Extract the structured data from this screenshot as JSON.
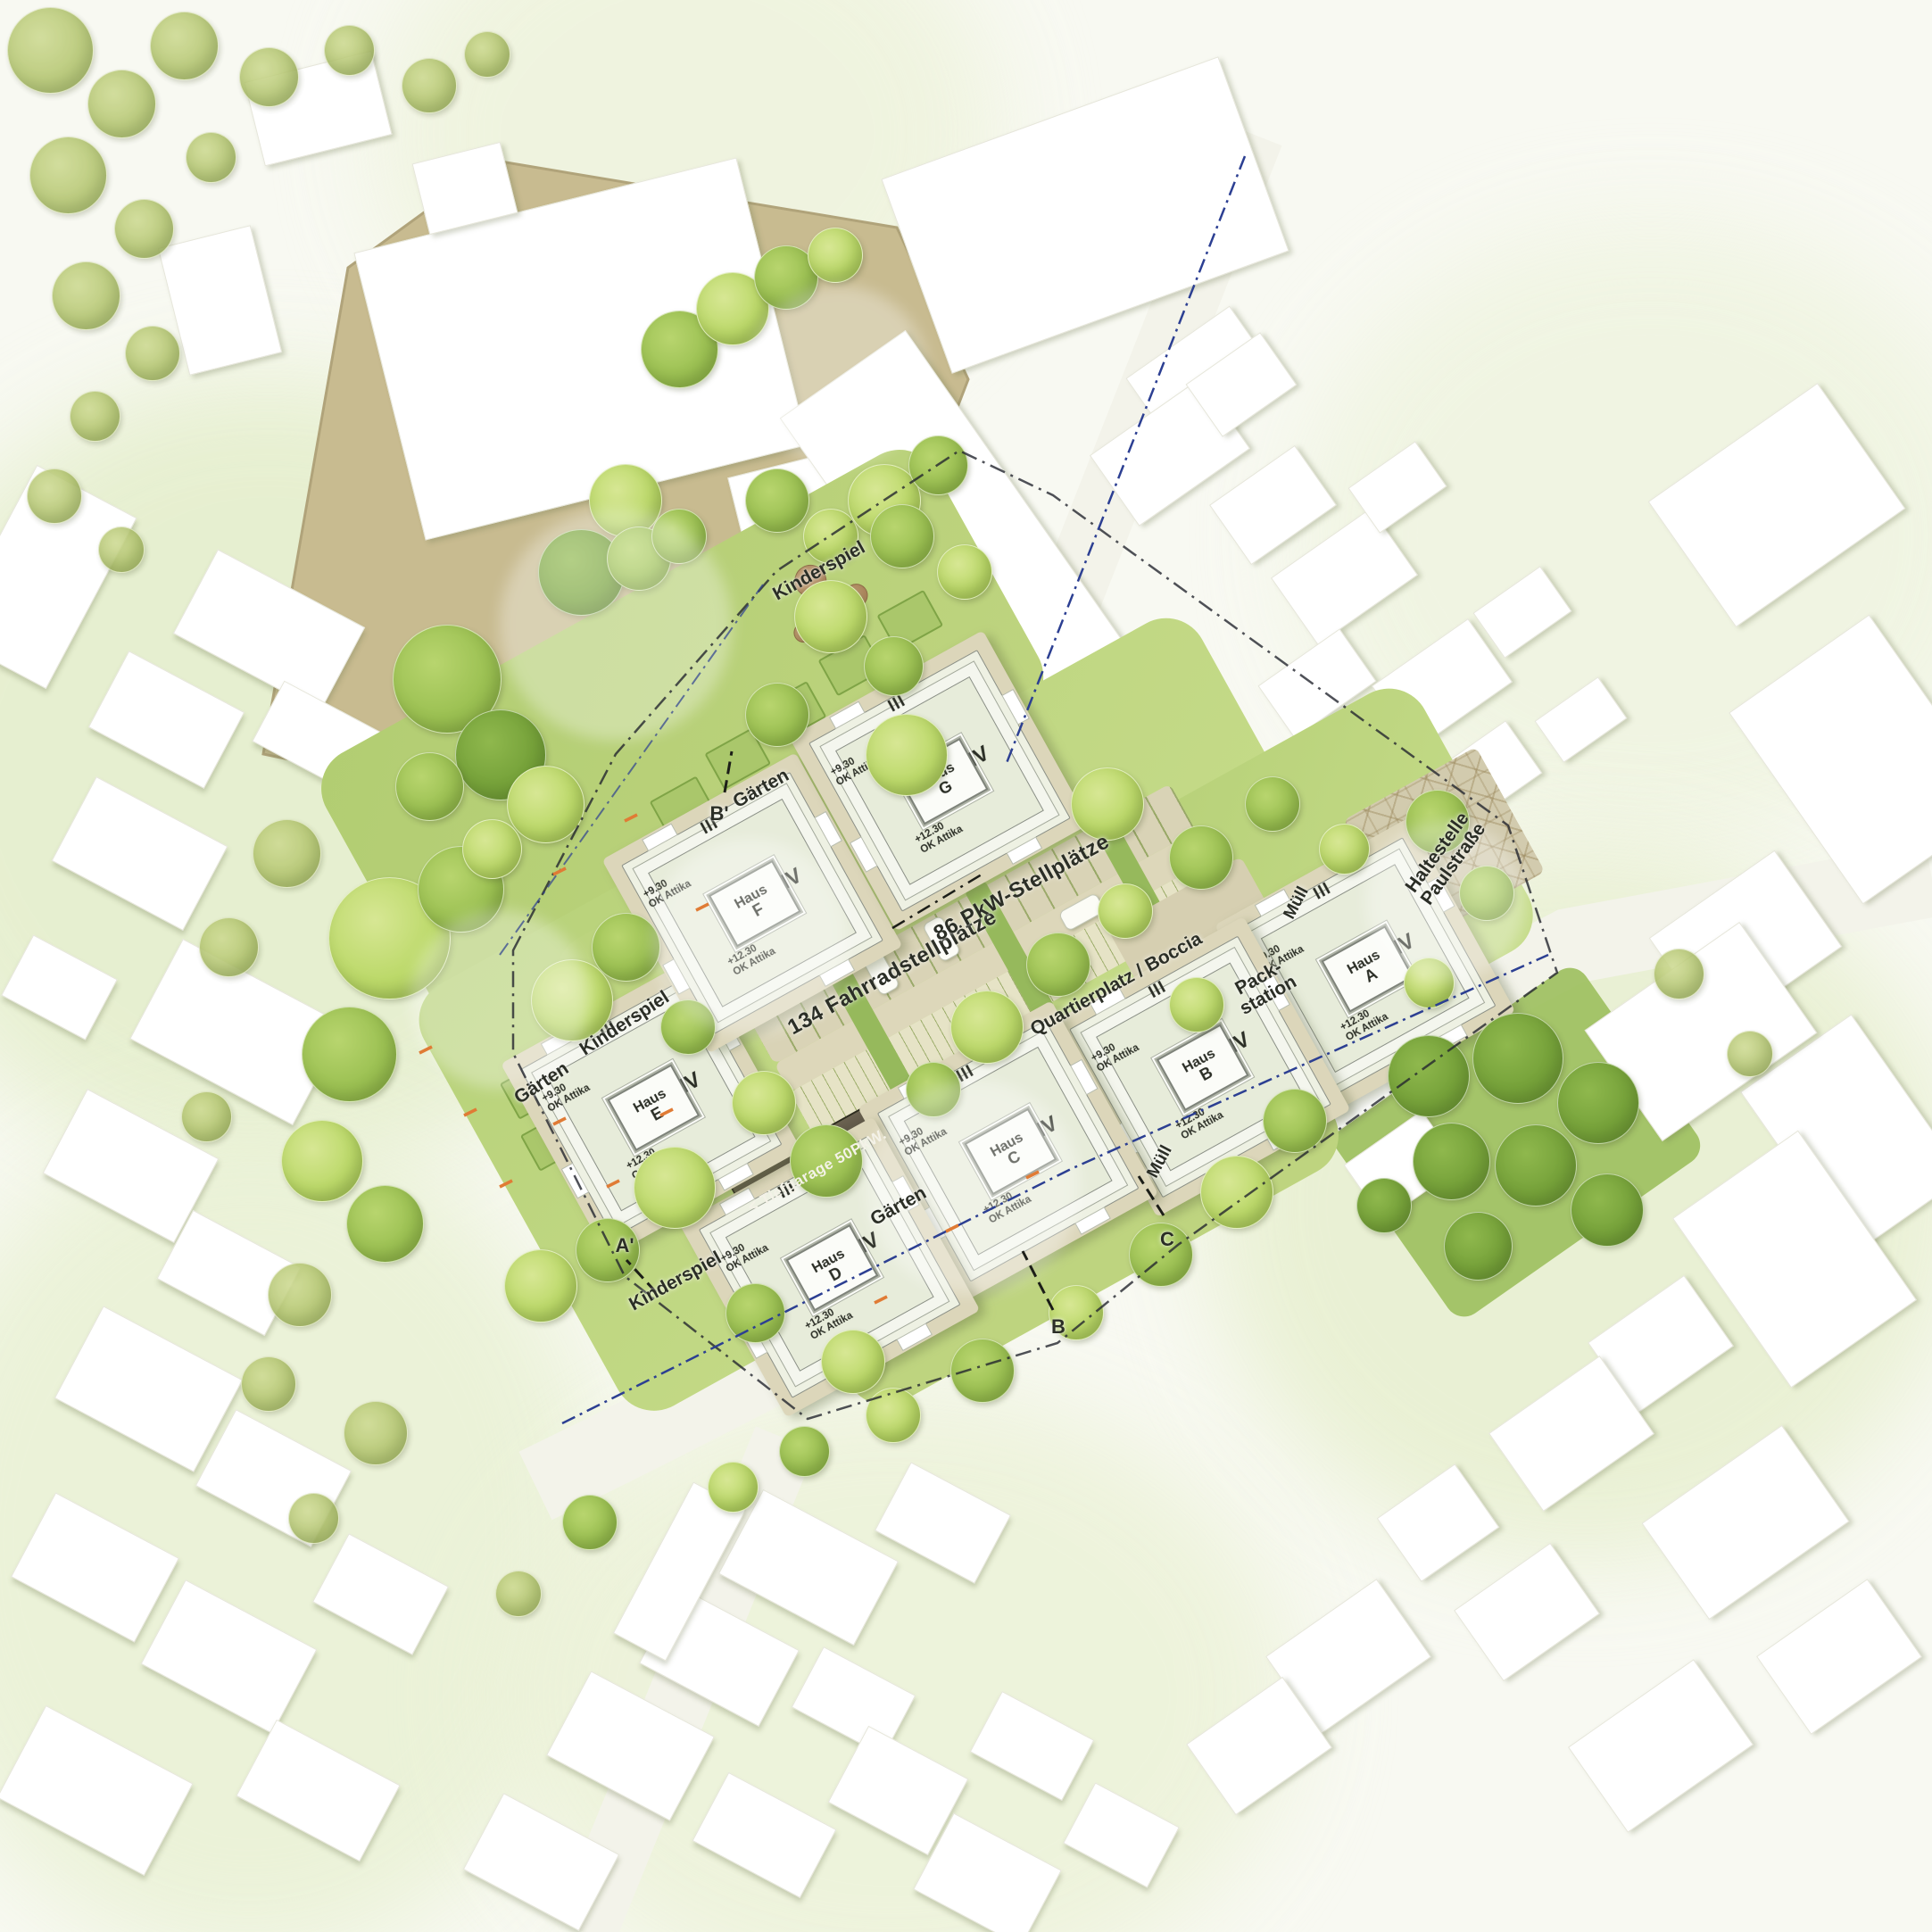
{
  "site": {
    "buildings": [
      {
        "label": "Haus",
        "letter": "A"
      },
      {
        "label": "Haus",
        "letter": "B"
      },
      {
        "label": "Haus",
        "letter": "C"
      },
      {
        "label": "Haus",
        "letter": "D"
      },
      {
        "label": "Haus",
        "letter": "E"
      },
      {
        "label": "Haus",
        "letter": "F"
      },
      {
        "label": "Haus",
        "letter": "G"
      }
    ],
    "building_common": {
      "wing_floors": "III",
      "main_floors": "IV",
      "wing_elevation": "+9.30",
      "main_elevation": "+12.30",
      "attika": "OK Attika"
    },
    "labels": {
      "car_parking": "86 PkW-Stellplätze",
      "bike_parking": "134 Fahrradstellplätze",
      "underground_garage": "< Tiefgarage 50PkW.",
      "plaza": "Quartierplatz / Boccia",
      "bus_stop_line1": "Haltestelle",
      "bus_stop_line2": "Paulstraße",
      "packstation_line1": "Pack-",
      "packstation_line2": "station",
      "waste": "Müll",
      "playground": "Kinderspiel",
      "gardens": "Gärten"
    },
    "section_markers": {
      "a_prime": "A'",
      "b": "B",
      "b_prime": "B'",
      "c": "C"
    }
  },
  "palette": {
    "background": "#f8f9f2",
    "lawn": "#bcd47e",
    "tree_light": "#bcd96a",
    "tree_mid": "#9cc153",
    "tree_dark": "#76a23a",
    "paving": "#d9d3b6",
    "schoolyard_tan": "#c8bb90",
    "building_white": "#ffffff",
    "roof_green": "#e7ecda",
    "garage_dark": "#4f4a3a",
    "boundary_blue": "#2c3f92",
    "accent_orange": "#e07b35"
  }
}
